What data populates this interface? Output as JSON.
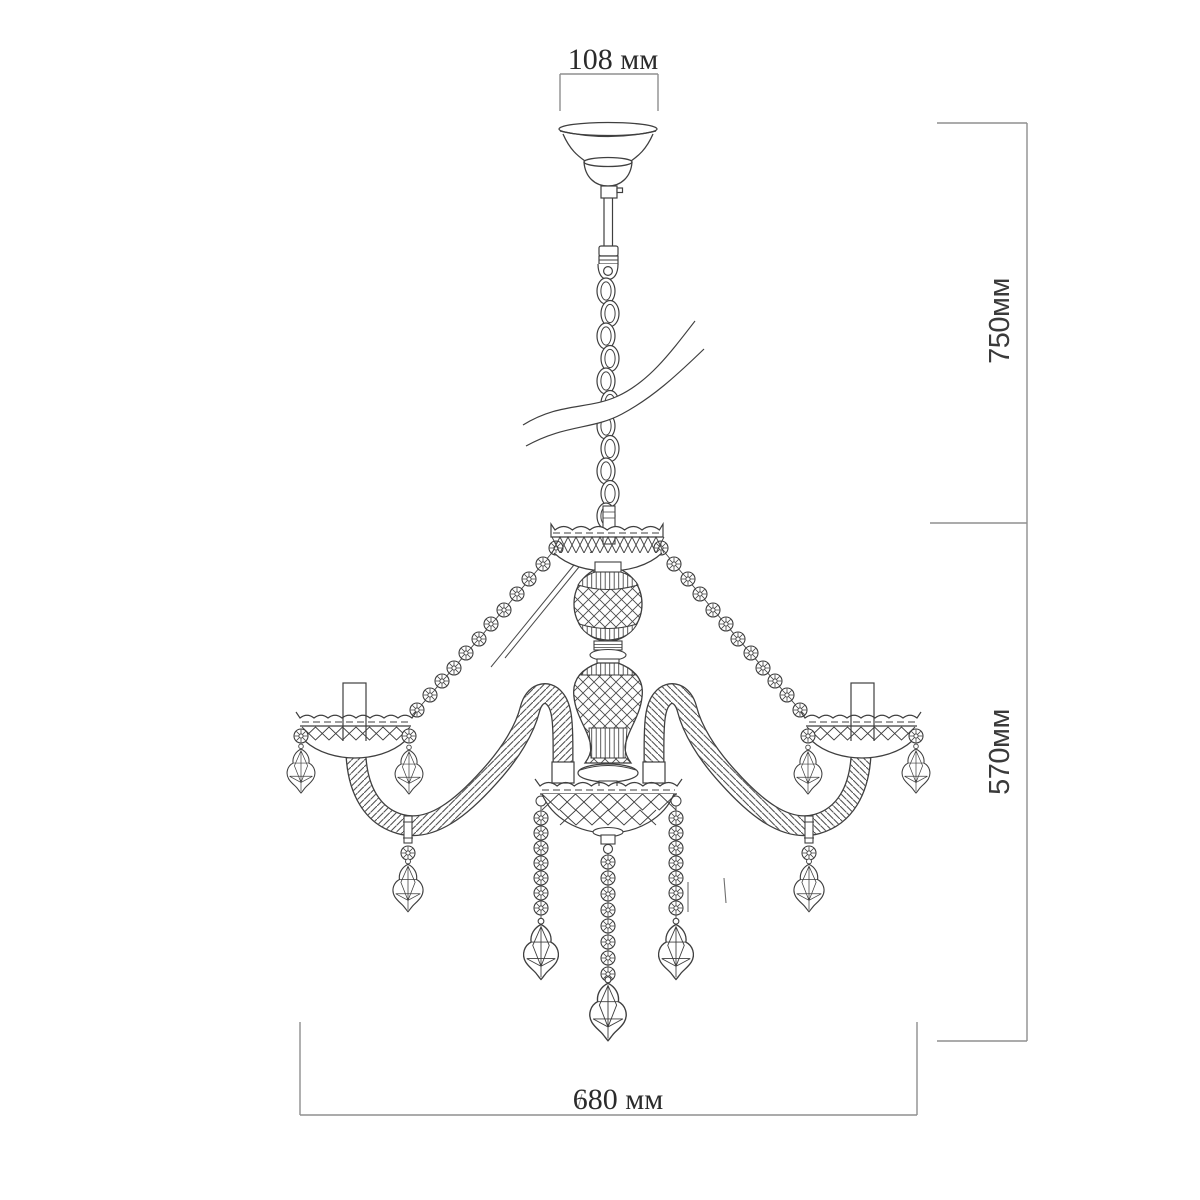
{
  "meta": {
    "title": "Chandelier technical dimension drawing",
    "units": "мм"
  },
  "dimensions": {
    "top": {
      "label": "108 мм",
      "value": 108,
      "unit": "мм"
    },
    "right_upper": {
      "label": "750мм",
      "value": 750,
      "unit": "мм"
    },
    "right_lower": {
      "label": "570мм",
      "value": 570,
      "unit": "мм"
    },
    "bottom": {
      "label": "680 мм",
      "value": 680,
      "unit": "мм"
    }
  },
  "colors": {
    "background": "#ffffff",
    "drawing_stroke": "#3f3f3f",
    "dimension_stroke": "#8f8f8f",
    "text": "#2b2b2b"
  }
}
